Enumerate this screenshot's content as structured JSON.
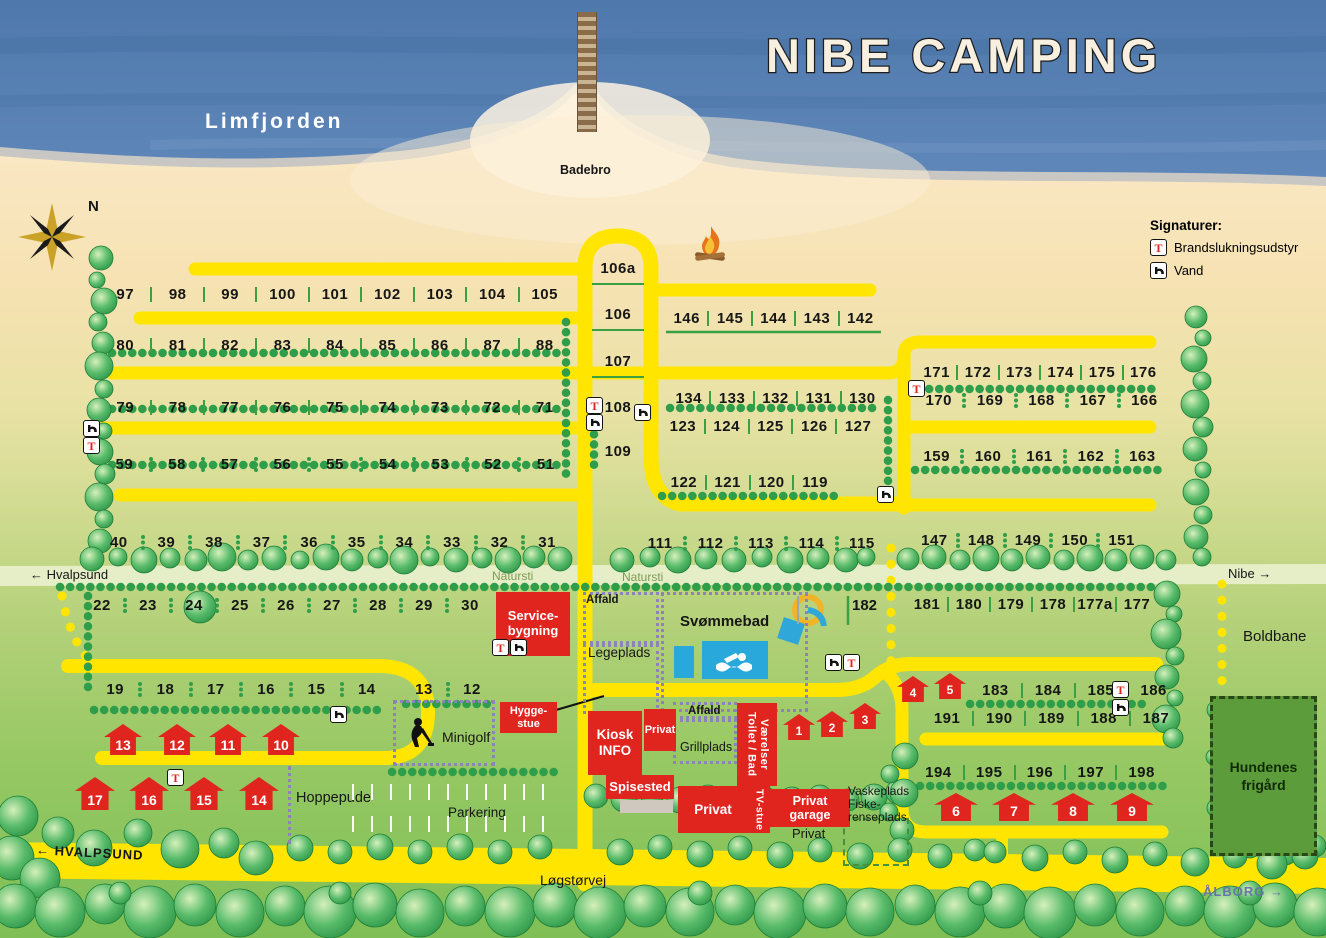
{
  "title": "NIBE CAMPING",
  "water": {
    "name": "Limfjorden",
    "pier_label": "Badebro"
  },
  "compass_label": "N",
  "legend": {
    "title": "Signaturer:",
    "items": [
      {
        "icon": "fire-extinguisher",
        "label": "Brandslukningsudstyr"
      },
      {
        "icon": "water-tap",
        "label": "Vand"
      }
    ]
  },
  "paths": {
    "hvalpsund_path": "Hvalpsund",
    "natursti": "Natursti",
    "nibe": "Nibe",
    "hvalpsund_road": "HVALPSUND",
    "logstorvej": "Løgstørvej",
    "aalborg": "ÅLBORG"
  },
  "arrows": {
    "left": "←",
    "right": "→"
  },
  "plot_rows": {
    "r97": [
      "97",
      "98",
      "99",
      "100",
      "101",
      "102",
      "103",
      "104",
      "105"
    ],
    "r80": [
      "80",
      "81",
      "82",
      "83",
      "84",
      "85",
      "86",
      "87",
      "88"
    ],
    "r79": [
      "79",
      "78",
      "77",
      "76",
      "75",
      "74",
      "73",
      "72",
      "71"
    ],
    "r59": [
      "59",
      "58",
      "57",
      "56",
      "55",
      "54",
      "53",
      "52",
      "51"
    ],
    "r40": [
      "40",
      "39",
      "38",
      "37",
      "36",
      "35",
      "34",
      "33",
      "32",
      "31"
    ],
    "r22": [
      "22",
      "23",
      "24",
      "25",
      "26",
      "27",
      "28",
      "29",
      "30"
    ],
    "r19": [
      "19",
      "18",
      "17",
      "16",
      "15",
      "14"
    ],
    "r13": [
      "13",
      "12"
    ],
    "center": [
      "106a",
      "106",
      "107",
      "108",
      "109"
    ],
    "r146": [
      "146",
      "145",
      "144",
      "143",
      "142"
    ],
    "r134": [
      "134",
      "133",
      "132",
      "131",
      "130"
    ],
    "r123": [
      "123",
      "124",
      "125",
      "126",
      "127"
    ],
    "r122": [
      "122",
      "121",
      "120",
      "119"
    ],
    "r111": [
      "111",
      "112",
      "113",
      "114",
      "115"
    ],
    "r171": [
      "171",
      "172",
      "173",
      "174",
      "175",
      "176"
    ],
    "r170": [
      "170",
      "169",
      "168",
      "167",
      "166"
    ],
    "r159": [
      "159",
      "160",
      "161",
      "162",
      "163"
    ],
    "r147": [
      "147",
      "148",
      "149",
      "150",
      "151"
    ],
    "r181": [
      "181",
      "180",
      "179",
      "178",
      "177a",
      "177"
    ],
    "p182": "182",
    "r183": [
      "183",
      "184",
      "185",
      "186"
    ],
    "r191": [
      "191",
      "190",
      "189",
      "188",
      "187"
    ],
    "r194": [
      "194",
      "195",
      "196",
      "197",
      "198"
    ]
  },
  "cabins": {
    "rowA": [
      "13",
      "12",
      "11",
      "10"
    ],
    "rowB": [
      "17",
      "16",
      "15",
      "14"
    ],
    "pair45": [
      "4",
      "5"
    ],
    "trio123": [
      "1",
      "2",
      "3"
    ],
    "row6789": [
      "6",
      "7",
      "8",
      "9"
    ]
  },
  "buildings": {
    "service": {
      "l1": "Service-",
      "l2": "bygning"
    },
    "hygge": {
      "l1": "Hygge-",
      "l2": "stue"
    },
    "kiosk": {
      "l1": "Kiosk",
      "l2": "INFO"
    },
    "privat_small": "Privat",
    "spisested": "Spisested",
    "privat_large": "Privat",
    "toilet": {
      "l1": "Toilet / Bad",
      "l2": "Værelser"
    },
    "tv": "TV-stue",
    "garage": {
      "l1": "Privat",
      "l2": "garage"
    },
    "vaskeplads": {
      "l1": "Vaskeplads",
      "l2": "Fiske-",
      "l3": "renseplads"
    },
    "privat_ground": "Privat"
  },
  "areas": {
    "affald_top": "Affald",
    "legeplads": "Legeplads",
    "svommebad": "Svømmebad",
    "affald_mid": "Affald",
    "grillplads": "Grillplads",
    "minigolf": "Minigolf",
    "hoppepude": "Hoppepude",
    "parkering": "Parkering",
    "boldbane": "Boldbane",
    "hundenes": {
      "l1": "Hundenes",
      "l2": "frigård"
    }
  },
  "icons": {
    "fire_extinguisher": "T"
  },
  "colors": {
    "road_yellow": "#ffe500",
    "building_red": "#e0251f",
    "hedge_green": "#2f9e4a",
    "water_blue": "#5b81b4",
    "pool_blue": "#29a8dc"
  }
}
